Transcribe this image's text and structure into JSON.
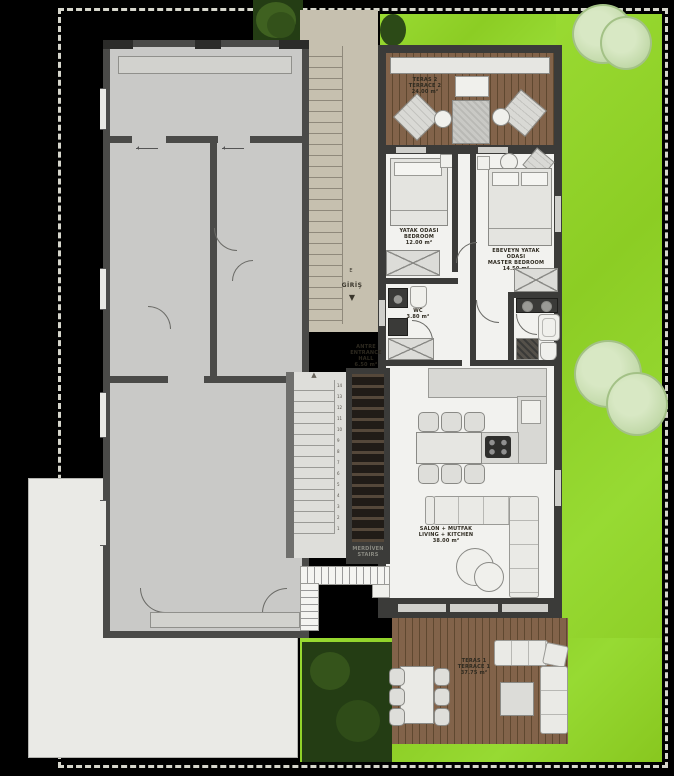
{
  "title": "villa-floor-plan",
  "palette": {
    "boundary": "#d6d6cc",
    "grass": "#8fd22a",
    "wood": "#7d5f41",
    "wall": "#3b3b39",
    "concrete": "#c6c0af",
    "neighbor_fill": "#c9c9c7",
    "floor": "#f2f2ef",
    "hedge": "#243d14",
    "tree": "#cfe2b8"
  },
  "labels": {
    "terrace2": [
      "TERAS 2",
      "TERRACE 2",
      "24.00 m²"
    ],
    "bedroom2": [
      "YATAK ODASI",
      "BEDROOM",
      "12.00 m²"
    ],
    "wc": [
      "WC",
      "3.80 m²"
    ],
    "hall": [
      "ANTRE",
      "ENTRANCE HALL",
      "6.50 m²"
    ],
    "master": [
      "EBEVEYN YATAK ODASI",
      "MASTER BEDROOM",
      "14.50 m²"
    ],
    "stairs": [
      "MERDİVEN",
      "STAIRS"
    ],
    "living": [
      "SALON + MUTFAK",
      "LIVING + KITCHEN",
      "38.00 m²"
    ],
    "terrace1": [
      "TERAS 1",
      "TERRACE 1",
      "37.75 m²"
    ],
    "entrance": {
      "letter": "E",
      "word": "GİRİŞ",
      "down_arrow": "▼"
    },
    "stair_up_arrow": "▲",
    "stair_numbers": "14\n13\n12\n11\n10\n9\n8\n7\n6\n5\n4\n3\n2\n1"
  }
}
